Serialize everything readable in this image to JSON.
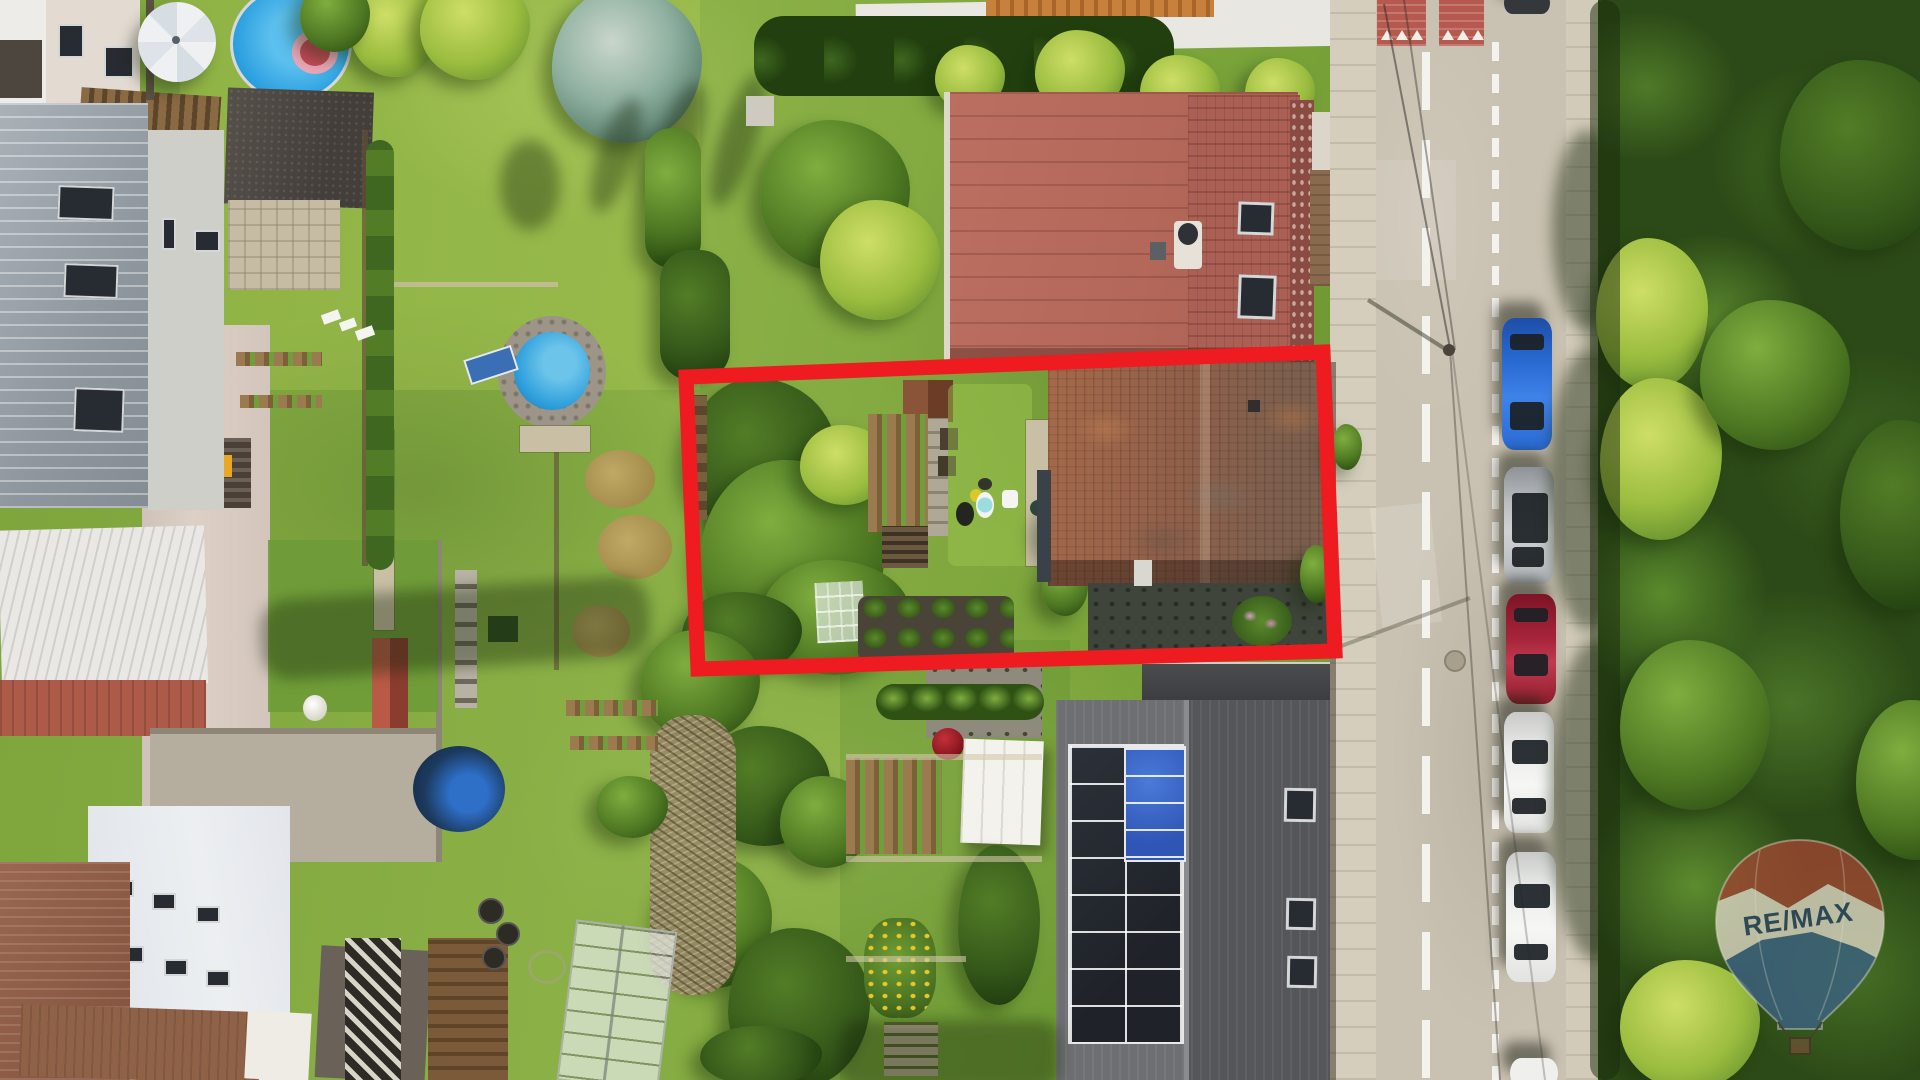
{
  "scene": {
    "type": "aerial-drone-photograph",
    "subject": "Top-down aerial view of residential parcels with gardens, swimming pools, a street with parked cars; the listed property (garden plus old tiled-roof house) is outlined in red",
    "orientation": "top-down"
  },
  "watermark": {
    "brand": "RE/MAX",
    "balloon": {
      "top_color": "#9a4631",
      "band_color": "#d8d2bf",
      "bottom_color": "#3c6180",
      "text_color": "#2b4562",
      "basket_color": "#6b5136"
    }
  },
  "property_outline": {
    "color": "#ee1b20",
    "stroke_width": 15,
    "points_str": "686,377 1323,352 1335,651 698,669"
  },
  "road": {
    "surface_color": "#c9c1b1",
    "sidewalk_color": "#d5cebc",
    "marking_color": "#f4f2ec",
    "traffic_calming_patch_color": "#b65a50",
    "parked_cars": [
      {
        "position": "top-edge-partial",
        "color": "dark-gray",
        "hex": "#34383b"
      },
      {
        "position": "1",
        "color": "blue",
        "hex": "#2a6bd4"
      },
      {
        "position": "2",
        "color": "silver",
        "hex": "#b9bdc1"
      },
      {
        "position": "3",
        "color": "dark-red",
        "hex": "#a5243a"
      },
      {
        "position": "4",
        "color": "white",
        "hex": "#e9eae8"
      },
      {
        "position": "5",
        "color": "white",
        "hex": "#eceeec"
      },
      {
        "position": "6",
        "color": "white-partial",
        "hex": "#eff0ee"
      }
    ]
  },
  "features": {
    "pools": [
      {
        "name": "large-above-ground-pool-top",
        "water_color": "#2b9fe0",
        "float_ring_color": "#eaa6b6"
      },
      {
        "name": "stone-edged-round-pool",
        "water_color": "#2ea0dc"
      },
      {
        "name": "covered-pool-bottom-left",
        "cover_color": "#1c3a5e"
      }
    ],
    "solar_roof": {
      "roof_color": "#55565a",
      "panel_dark": "#24282f",
      "panel_blue": "#2f55b5"
    },
    "main_house_roof_color": "#b4685a",
    "old_house_roof_color": "#91604a",
    "greenhouse_present": true,
    "umbrella_color": "#e6e9ec"
  }
}
